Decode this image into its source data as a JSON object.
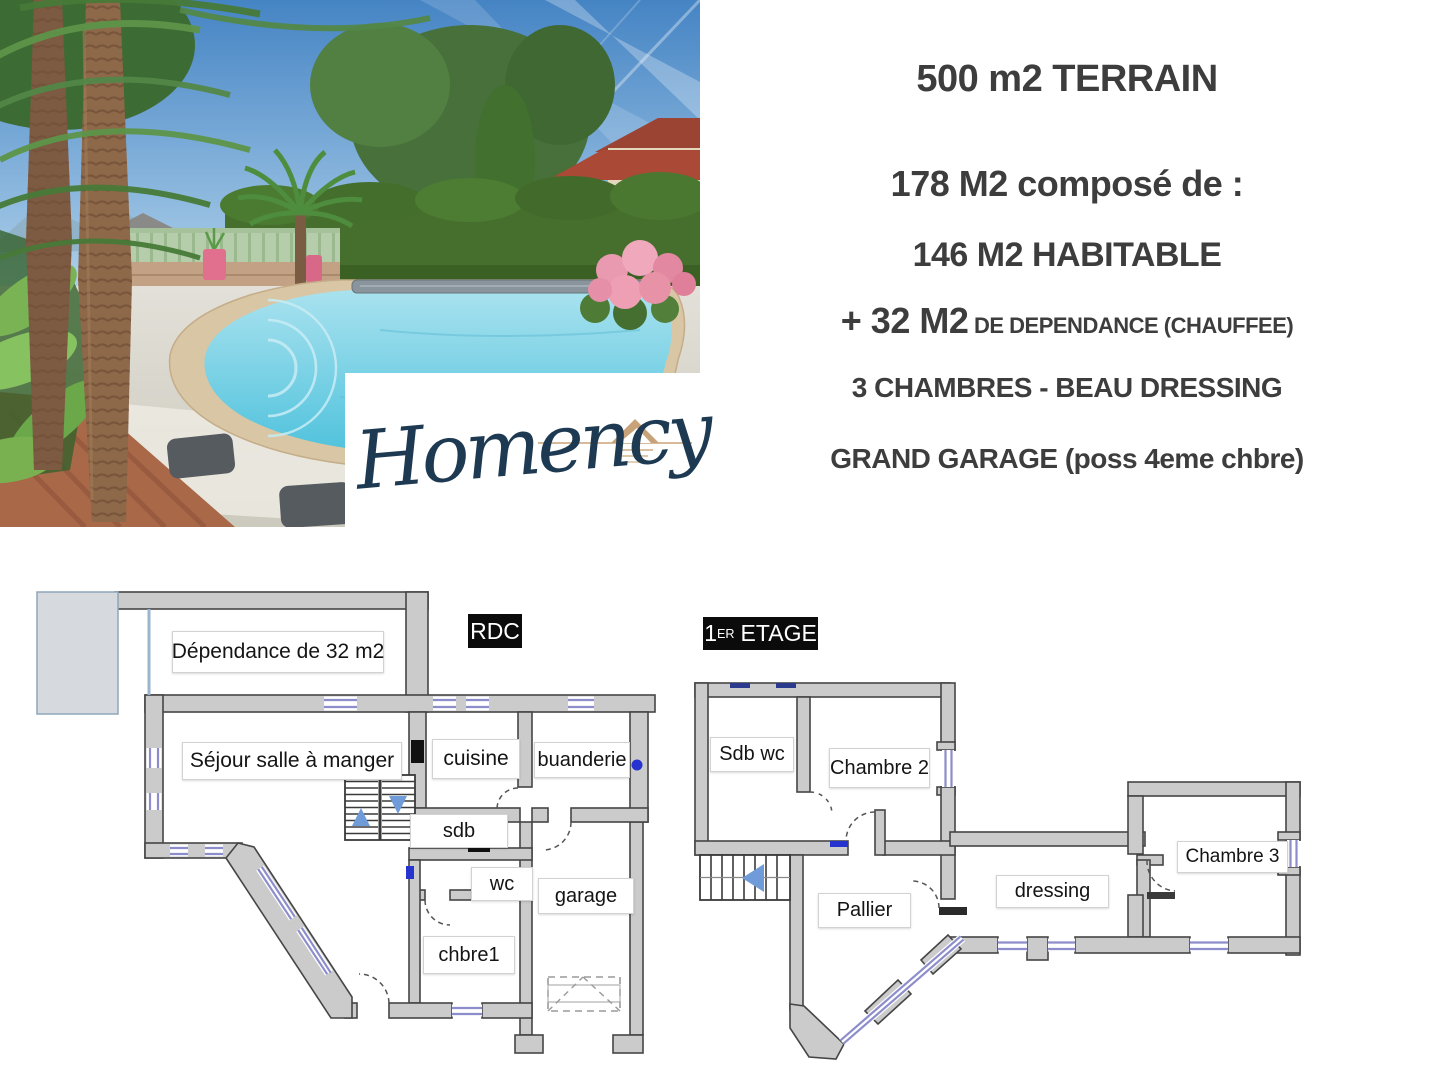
{
  "info": {
    "terrain": "500 m2 TERRAIN",
    "compose": "178 M2 composé de :",
    "habitable": "146 M2 HABITABLE",
    "dependance_big": "+ 32 M2",
    "dependance_small": " DE DEPENDANCE (CHAUFFEE)",
    "chambres": "3 CHAMBRES - BEAU DRESSING",
    "garage": "GRAND GARAGE (poss 4eme chbre)"
  },
  "logo": {
    "brand": "Homency"
  },
  "plans": {
    "rdc": {
      "tag": "RDC",
      "rooms": {
        "dependance": "Dépendance de 32 m2",
        "sejour": "Séjour salle à manger",
        "cuisine": "cuisine",
        "buanderie": "buanderie",
        "sdb": "sdb",
        "wc": "wc",
        "garage": "garage",
        "chbre1": "chbre1"
      }
    },
    "etage": {
      "tag_num": "1",
      "tag_sup": "ER",
      "tag_rest": "ETAGE",
      "rooms": {
        "sdbwc": "Sdb wc",
        "chambre2": "Chambre 2",
        "pallier": "Pallier",
        "dressing": "dressing",
        "chambre3": "Chambre 3"
      }
    }
  },
  "colors": {
    "accent_navy": "#1d3a52",
    "accent_gold": "#c8a379",
    "wall_gray": "#cbcbcb",
    "window_blue": "#8d8dcb",
    "text_dark": "#3d3d3d"
  }
}
